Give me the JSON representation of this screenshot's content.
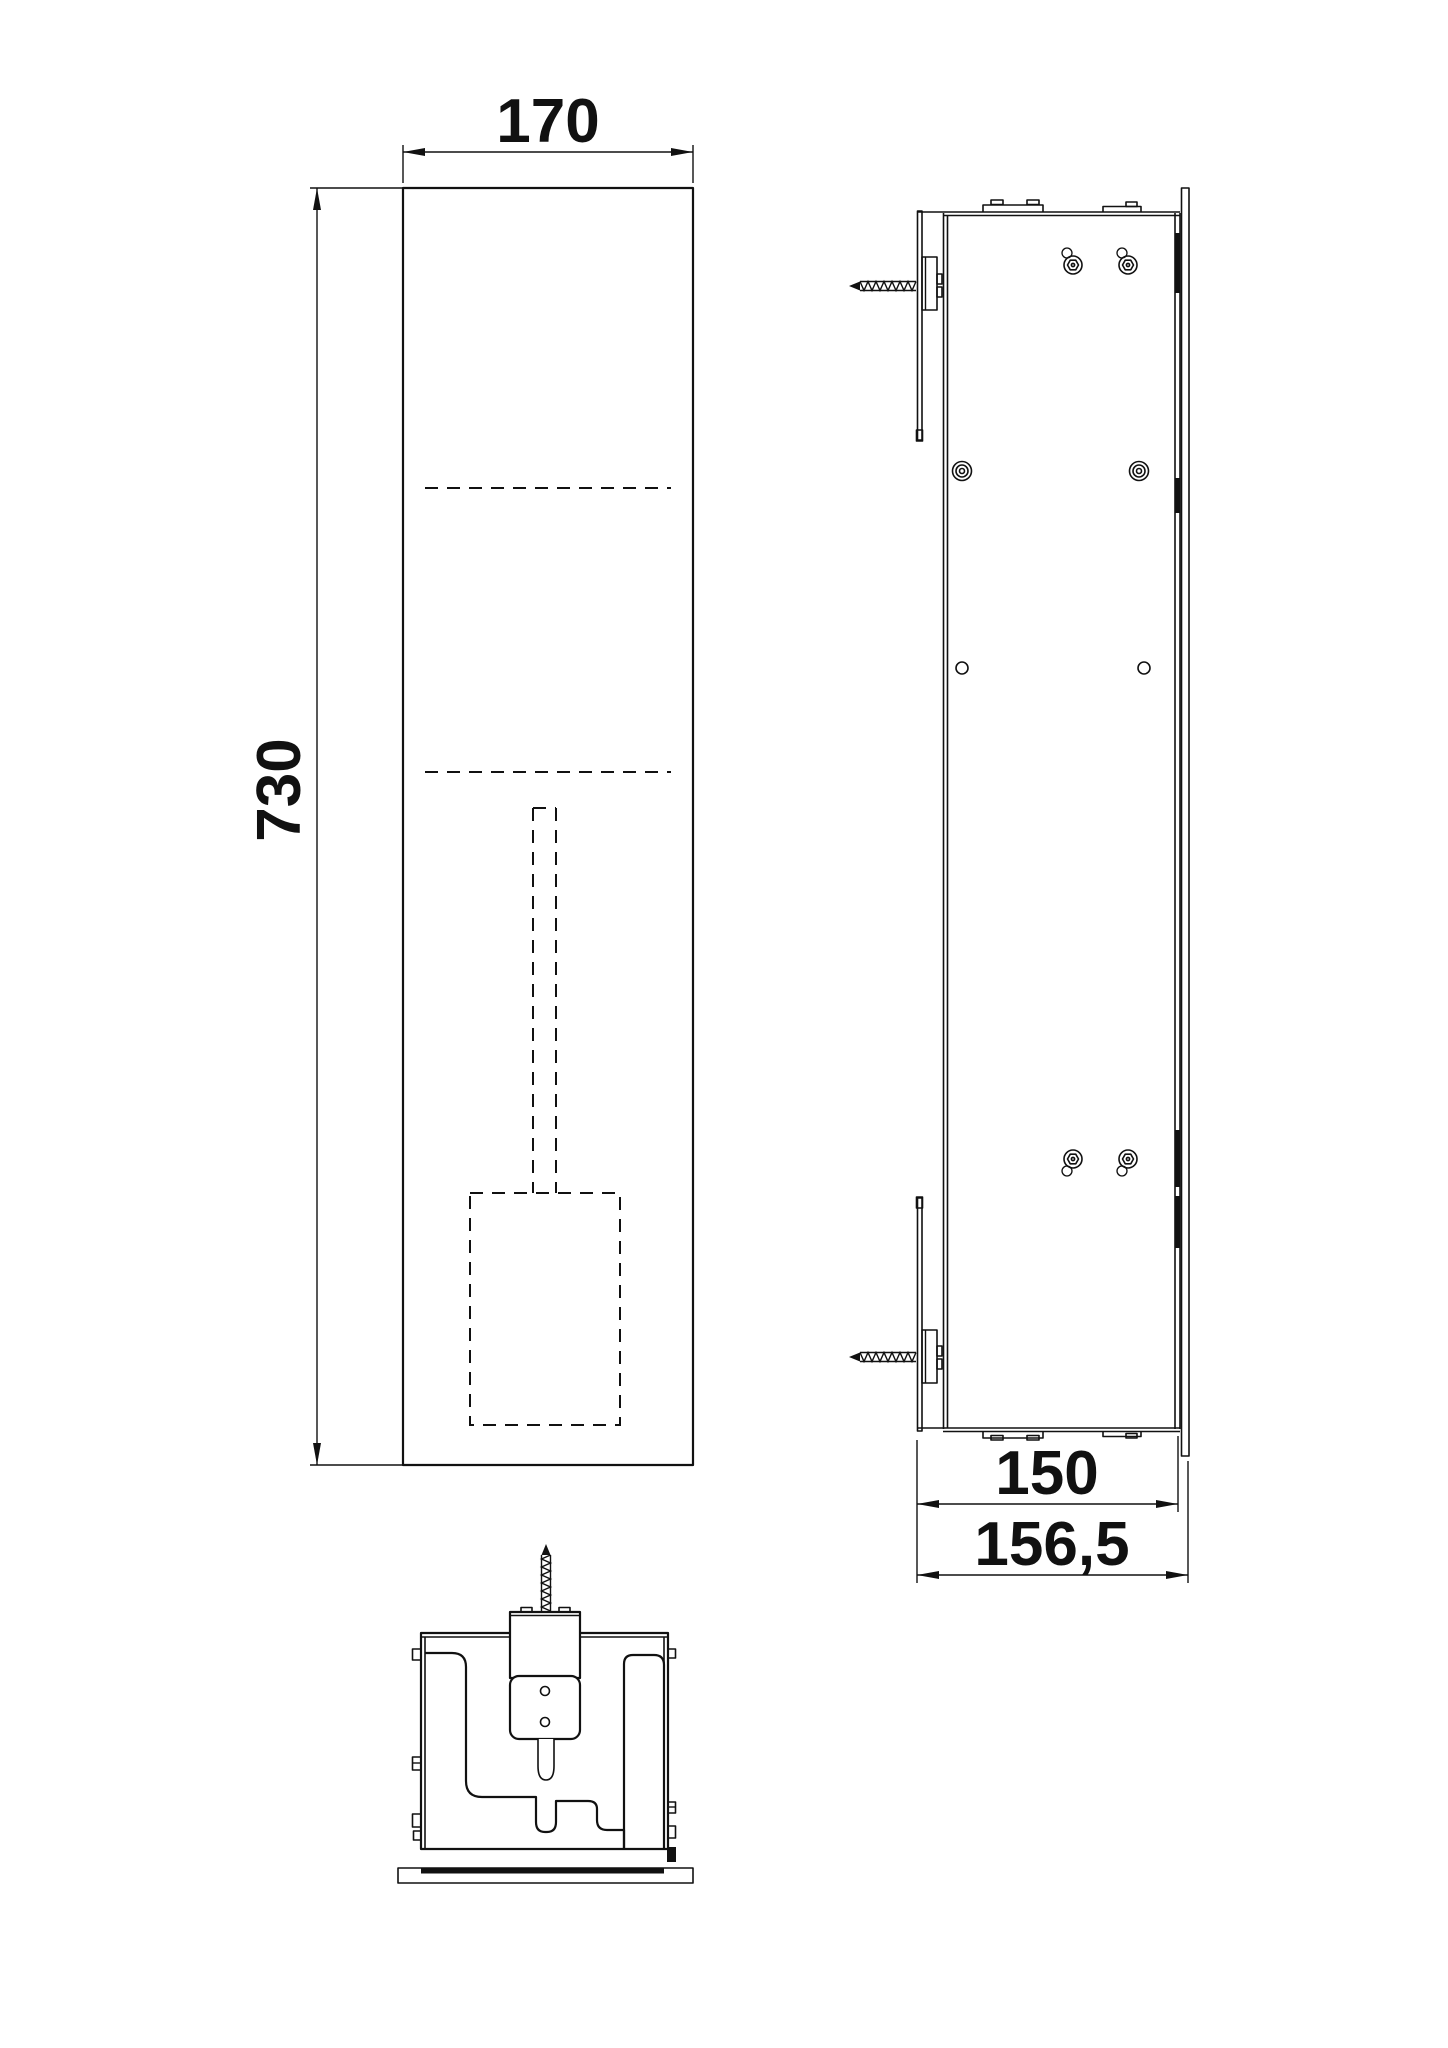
{
  "dims": {
    "front_width": "170",
    "front_height": "730",
    "box_depth": "150",
    "total_depth": "156,5"
  },
  "colors": {
    "line": "#111111",
    "background": "#ffffff"
  }
}
